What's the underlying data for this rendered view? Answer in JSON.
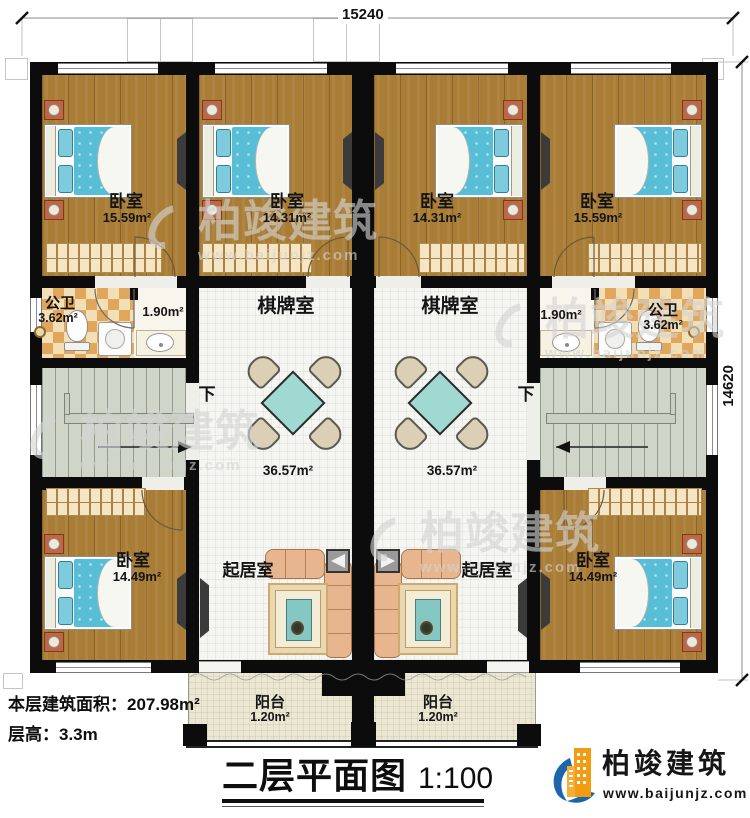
{
  "plan": {
    "dim_top": "15240",
    "dim_right": "14620",
    "down_label": "下"
  },
  "rooms": {
    "bedroom_tl": {
      "name": "卧室",
      "area": "15.59m²"
    },
    "bedroom_tml": {
      "name": "卧室",
      "area": "14.31m²"
    },
    "bedroom_tmr": {
      "name": "卧室",
      "area": "14.31m²"
    },
    "bedroom_tr": {
      "name": "卧室",
      "area": "15.59m²"
    },
    "bath_left": {
      "name": "公卫",
      "area": "3.62m²"
    },
    "hall_left": {
      "area": "1.90m²"
    },
    "hall_right": {
      "area": "1.90m²"
    },
    "bath_right": {
      "name": "公卫",
      "area": "3.62m²"
    },
    "games_left": {
      "name": "棋牌室",
      "area": "36.57m²"
    },
    "games_right": {
      "name": "棋牌室",
      "area": "36.57m²"
    },
    "living_left": {
      "name": "起居室"
    },
    "living_right": {
      "name": "起居室"
    },
    "bedroom_bl": {
      "name": "卧室",
      "area": "14.49m²"
    },
    "bedroom_br": {
      "name": "卧室",
      "area": "14.49m²"
    },
    "balcony_left": {
      "name": "阳台",
      "area": "1.20m²"
    },
    "balcony_right": {
      "name": "阳台",
      "area": "1.20m²"
    }
  },
  "info": {
    "floor_area": "本层建筑面积：207.98m²",
    "floor_height": "层高：3.3m"
  },
  "title_block": {
    "title": "二层平面图",
    "scale": "1:100"
  },
  "brand": {
    "name": "柏竣建筑",
    "site": "www.baijunjz.com"
  }
}
